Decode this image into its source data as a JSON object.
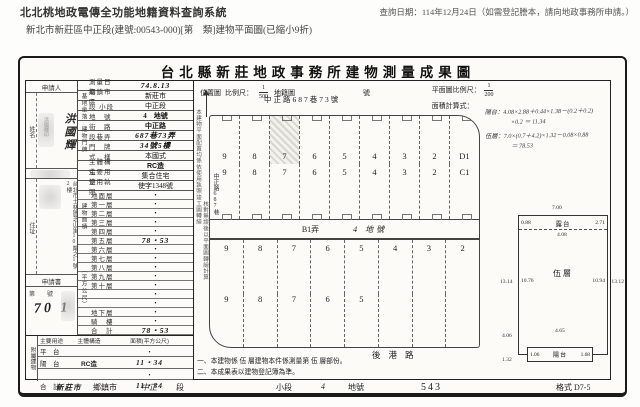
{
  "header": {
    "system_title": "北北桃地政電傳全功能地籍資料查詢系統",
    "query_date": "查詢日期：114年12月24日（如需登記謄本，請向地政事務所申請。）",
    "doc_line": "新北市新莊區中正段(建號:00543-000)[第　類]建物平面圖(已縮小9折)"
  },
  "doc": {
    "title": "台北縣新莊地政事務所建物測量成果圖",
    "map_header": {
      "location_label": "位置圖",
      "scale_label": "比例尺：",
      "scale_num": "1",
      "scale_den": "500",
      "cadastral_label": "地籍圖",
      "sheet_label": "號",
      "plan_scale_label": "平面圖比例尺：",
      "plan_num": "1",
      "plan_den": "200",
      "area_label": "面積計算式："
    }
  },
  "form": {
    "applicant_label": "申請人",
    "name_label": "姓名",
    "name": "洪國輝",
    "addr_label": "住址",
    "address": "台北市士林區芝山里10鄰之1號2樓",
    "stamp_text": "洪國輝印",
    "application_label": "申請書",
    "receipt_line": "第　　號",
    "receipt_no": "70 1",
    "groups": {
      "g1": "基地坐落",
      "g2": "建物門牌",
      "g3": "建物面積",
      "g4": "（平方公尺）"
    },
    "rows": [
      {
        "label": "測量日期",
        "value": "74.8.13"
      },
      {
        "label": "鄉鎮市區",
        "value": "新莊市"
      },
      {
        "label": "段 小段",
        "value": "中正段"
      },
      {
        "label": "地　號",
        "value": "4　地號"
      },
      {
        "label": "街　路",
        "value": "中正路"
      },
      {
        "label": "段巷弄",
        "value": "687巷73弄"
      },
      {
        "label": "門　牌",
        "value": "34號5樓"
      },
      {
        "label": "式　樣",
        "value": "本國式"
      },
      {
        "label": "主體構造",
        "value": "RC造"
      },
      {
        "label": "主要用途",
        "value": "集合住宅"
      },
      {
        "label": "使用執照",
        "value": "使字1348號"
      }
    ],
    "floors": [
      {
        "label": "地面層",
        "value": "・"
      },
      {
        "label": "第一層",
        "value": "・"
      },
      {
        "label": "第二層",
        "value": "・"
      },
      {
        "label": "第三層",
        "value": "・"
      },
      {
        "label": "第四層",
        "value": "・"
      },
      {
        "label": "第五層",
        "value": "78・53"
      },
      {
        "label": "第六層",
        "value": "・"
      },
      {
        "label": "第七層",
        "value": "・"
      },
      {
        "label": "第八層",
        "value": "・"
      },
      {
        "label": "第九層",
        "value": "・"
      },
      {
        "label": "第十層",
        "value": "・"
      },
      {
        "label": "",
        "value": "・"
      },
      {
        "label": "",
        "value": "・"
      },
      {
        "label": "地下層",
        "value": "・"
      },
      {
        "label": "騎　樓",
        "value": "・"
      },
      {
        "label": "合　計",
        "value": "78・53"
      }
    ],
    "annex": {
      "group_label": "附屬建物",
      "headers": [
        "主要用途",
        "主體構造",
        "面積(平方公尺)"
      ],
      "rows": [
        {
          "use": "平　台",
          "structure": "",
          "area": "・"
        },
        {
          "use": "陽　台",
          "structure": "RC造",
          "area": "11・34"
        },
        {
          "use": "",
          "structure": "",
          "area": "・"
        },
        {
          "use": "合　計",
          "structure": "",
          "area": "11・34"
        }
      ]
    }
  },
  "plan": {
    "street_top": "中正路687巷73號",
    "street_left": "中正路687巷",
    "side_note_1": "本建物平面配置均係依使用執照竣工圖轉繪",
    "side_note_2": "核對無誤後以平面圖轉繪計算",
    "rows": [
      {
        "cells": [
          "9",
          "8",
          "7",
          "6",
          "5",
          "4",
          "3",
          "2",
          "D1"
        ]
      },
      {
        "cells": [
          "9",
          "8",
          "7",
          "6",
          "5",
          "4",
          "3",
          "2",
          "C1"
        ]
      },
      {
        "cells": [
          "9",
          "8",
          "7",
          "6",
          "5",
          "4",
          "3",
          "2"
        ]
      },
      {
        "cells": [
          "9",
          "8",
          "7",
          "6",
          "5",
          "",
          "",
          ""
        ]
      }
    ],
    "lane_label": "B1弄",
    "lane_lot": "4 地號",
    "street_bottom": "後港路",
    "formulas": [
      "陽台：4.08×2.88＋0.44×1.38－(0.2＋0.2)",
      "×0.2 ＝ 11.34",
      "伍層：7.0×(0.7＋4.2)×1.32－0.08×0.88",
      "＝ 78.53"
    ]
  },
  "inset": {
    "dim_top": "7.00",
    "top_left": "0.88",
    "top_label": "露台",
    "top_right": "2.71",
    "top_width": "4.08",
    "left_outer": "13.14",
    "left_inner": "10.76",
    "room_label": "伍層",
    "right_inner": "10.94",
    "right_outer": "13.12",
    "bottom_inner_width": "4.65",
    "balcony_left": "1.06",
    "balcony_label": "陽台",
    "balcony_right": "1.68",
    "left_lower_1": "4.06",
    "left_lower_2": "1.32"
  },
  "notes": [
    "一、本建物係 伍 層建物本件係測量第 伍 層部份。",
    "二、本成果表以建物登記簿為準。"
  ],
  "footer_items": [
    "新莊市",
    "鄉鎮市",
    "中正",
    "段",
    "小段",
    "4",
    "地號",
    "543",
    "格式 D7-5"
  ]
}
